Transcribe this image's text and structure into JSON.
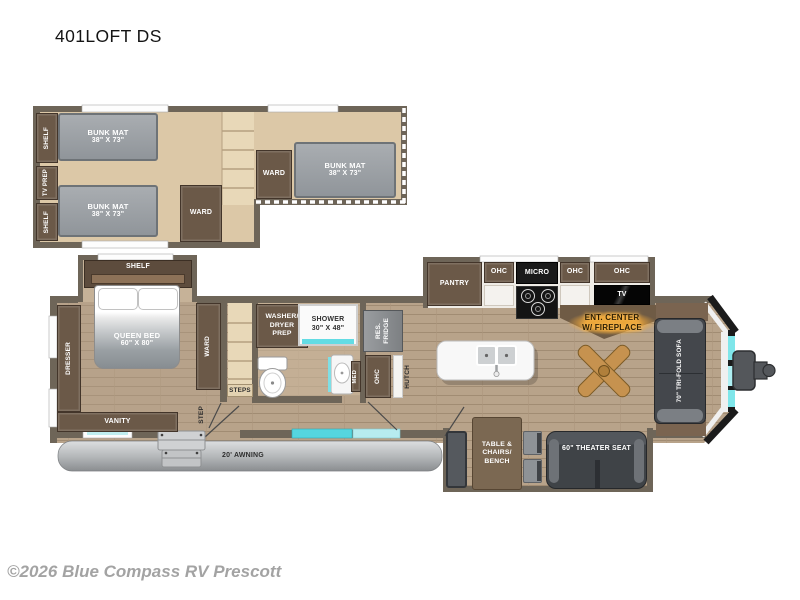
{
  "title": "401LOFT DS",
  "copyright": "©2026 Blue Compass RV Prescott",
  "colors": {
    "wall": "#6e6558",
    "loft_floor": "#dcc8a7",
    "window_accent": "#55d6df",
    "highlight": "#ffb143"
  },
  "loft": {
    "shelf_top": "SHELF",
    "tv_prep": "TV PREP",
    "shelf_bottom": "SHELF",
    "bunks": [
      {
        "name": "BUNK MAT",
        "size": "38\" X 73\""
      },
      {
        "name": "BUNK MAT",
        "size": "38\" X 73\""
      },
      {
        "name": "BUNK MAT",
        "size": "38\" X 73\""
      }
    ],
    "ward_left": "WARD",
    "ward_right": "WARD"
  },
  "bedroom": {
    "shelf": "SHELF",
    "bed_name": "QUEEN BED",
    "bed_size": "60\" X 80\"",
    "dresser": "DRESSER",
    "vanity": "VANITY",
    "ward": "WARD",
    "step": "STEP"
  },
  "bath": {
    "washer_line1": "WASHER/",
    "washer_line2": "DRYER",
    "washer_line3": "PREP",
    "shower_name": "SHOWER",
    "shower_size": "30\" X 48\"",
    "med": "MED",
    "steps": "STEPS"
  },
  "kitchen": {
    "fridge_line1": "RES.",
    "fridge_line2": "FRIDGE",
    "ohc_bath": "OHC",
    "hutch": "HUTCH",
    "pantry": "PANTRY",
    "ohc1": "OHC",
    "micro": "MICRO",
    "ohc2": "OHC",
    "ohc3": "OHC",
    "tv": "TV",
    "ent_line1": "ENT. CENTER",
    "ent_line2": "W/ FIREPLACE"
  },
  "living": {
    "sofa": "70\" TRI-FOLD SOFA",
    "table_line1": "TABLE &",
    "table_line2": "CHAIRS/",
    "table_line3": "BENCH",
    "theater": "60\" THEATER SEAT"
  },
  "exterior": {
    "awning": "20' AWNING"
  }
}
